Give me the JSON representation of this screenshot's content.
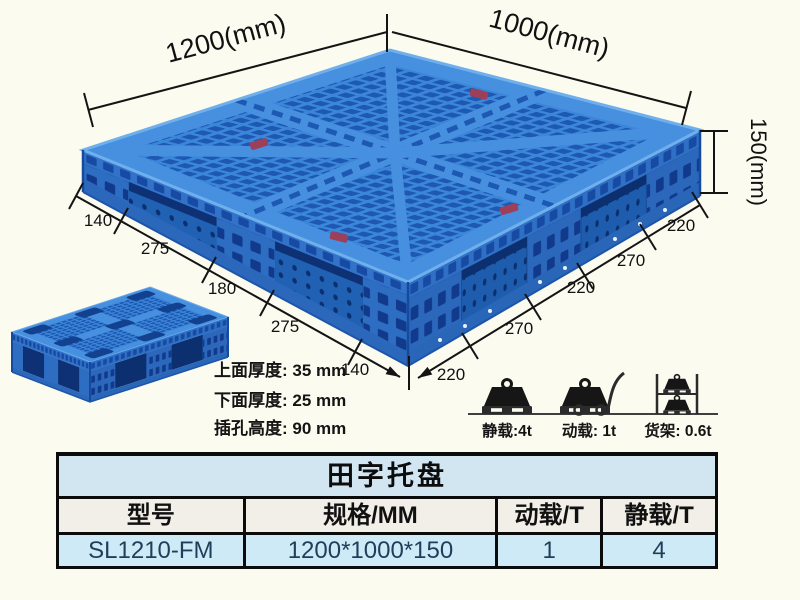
{
  "page": {
    "background": "#fbfbf0"
  },
  "diagram": {
    "length_label": "1200(mm)",
    "width_label": "1000(mm)",
    "height_label": "150(mm)",
    "bottom_left_dims": [
      "140",
      "275",
      "180",
      "275",
      "140"
    ],
    "bottom_right_dims": [
      "220",
      "270",
      "220",
      "270",
      "220"
    ],
    "thickness_notes": [
      "上面厚度: 35 mm",
      "下面厚度: 25 mm",
      "插孔高度: 90 mm"
    ],
    "load_ratings": [
      {
        "icon": "static-load-icon",
        "label": "静载:4t"
      },
      {
        "icon": "dynamic-load-icon",
        "label": "动载: 1t"
      },
      {
        "icon": "rack-load-icon",
        "label": "货架: 0.6t"
      }
    ],
    "pallet_colors": {
      "deck_blue": "#3b86d8",
      "hole_blue": "#1d58b2",
      "side_blue": "#2e6ec2",
      "pocket_blue": "#0d3174"
    }
  },
  "table": {
    "title": "田字托盘",
    "headers": [
      "型号",
      "规格/MM",
      "动载/T",
      "静载/T"
    ],
    "rows": [
      [
        "SL1210-FM",
        "1200*1000*150",
        "1",
        "4"
      ]
    ]
  }
}
